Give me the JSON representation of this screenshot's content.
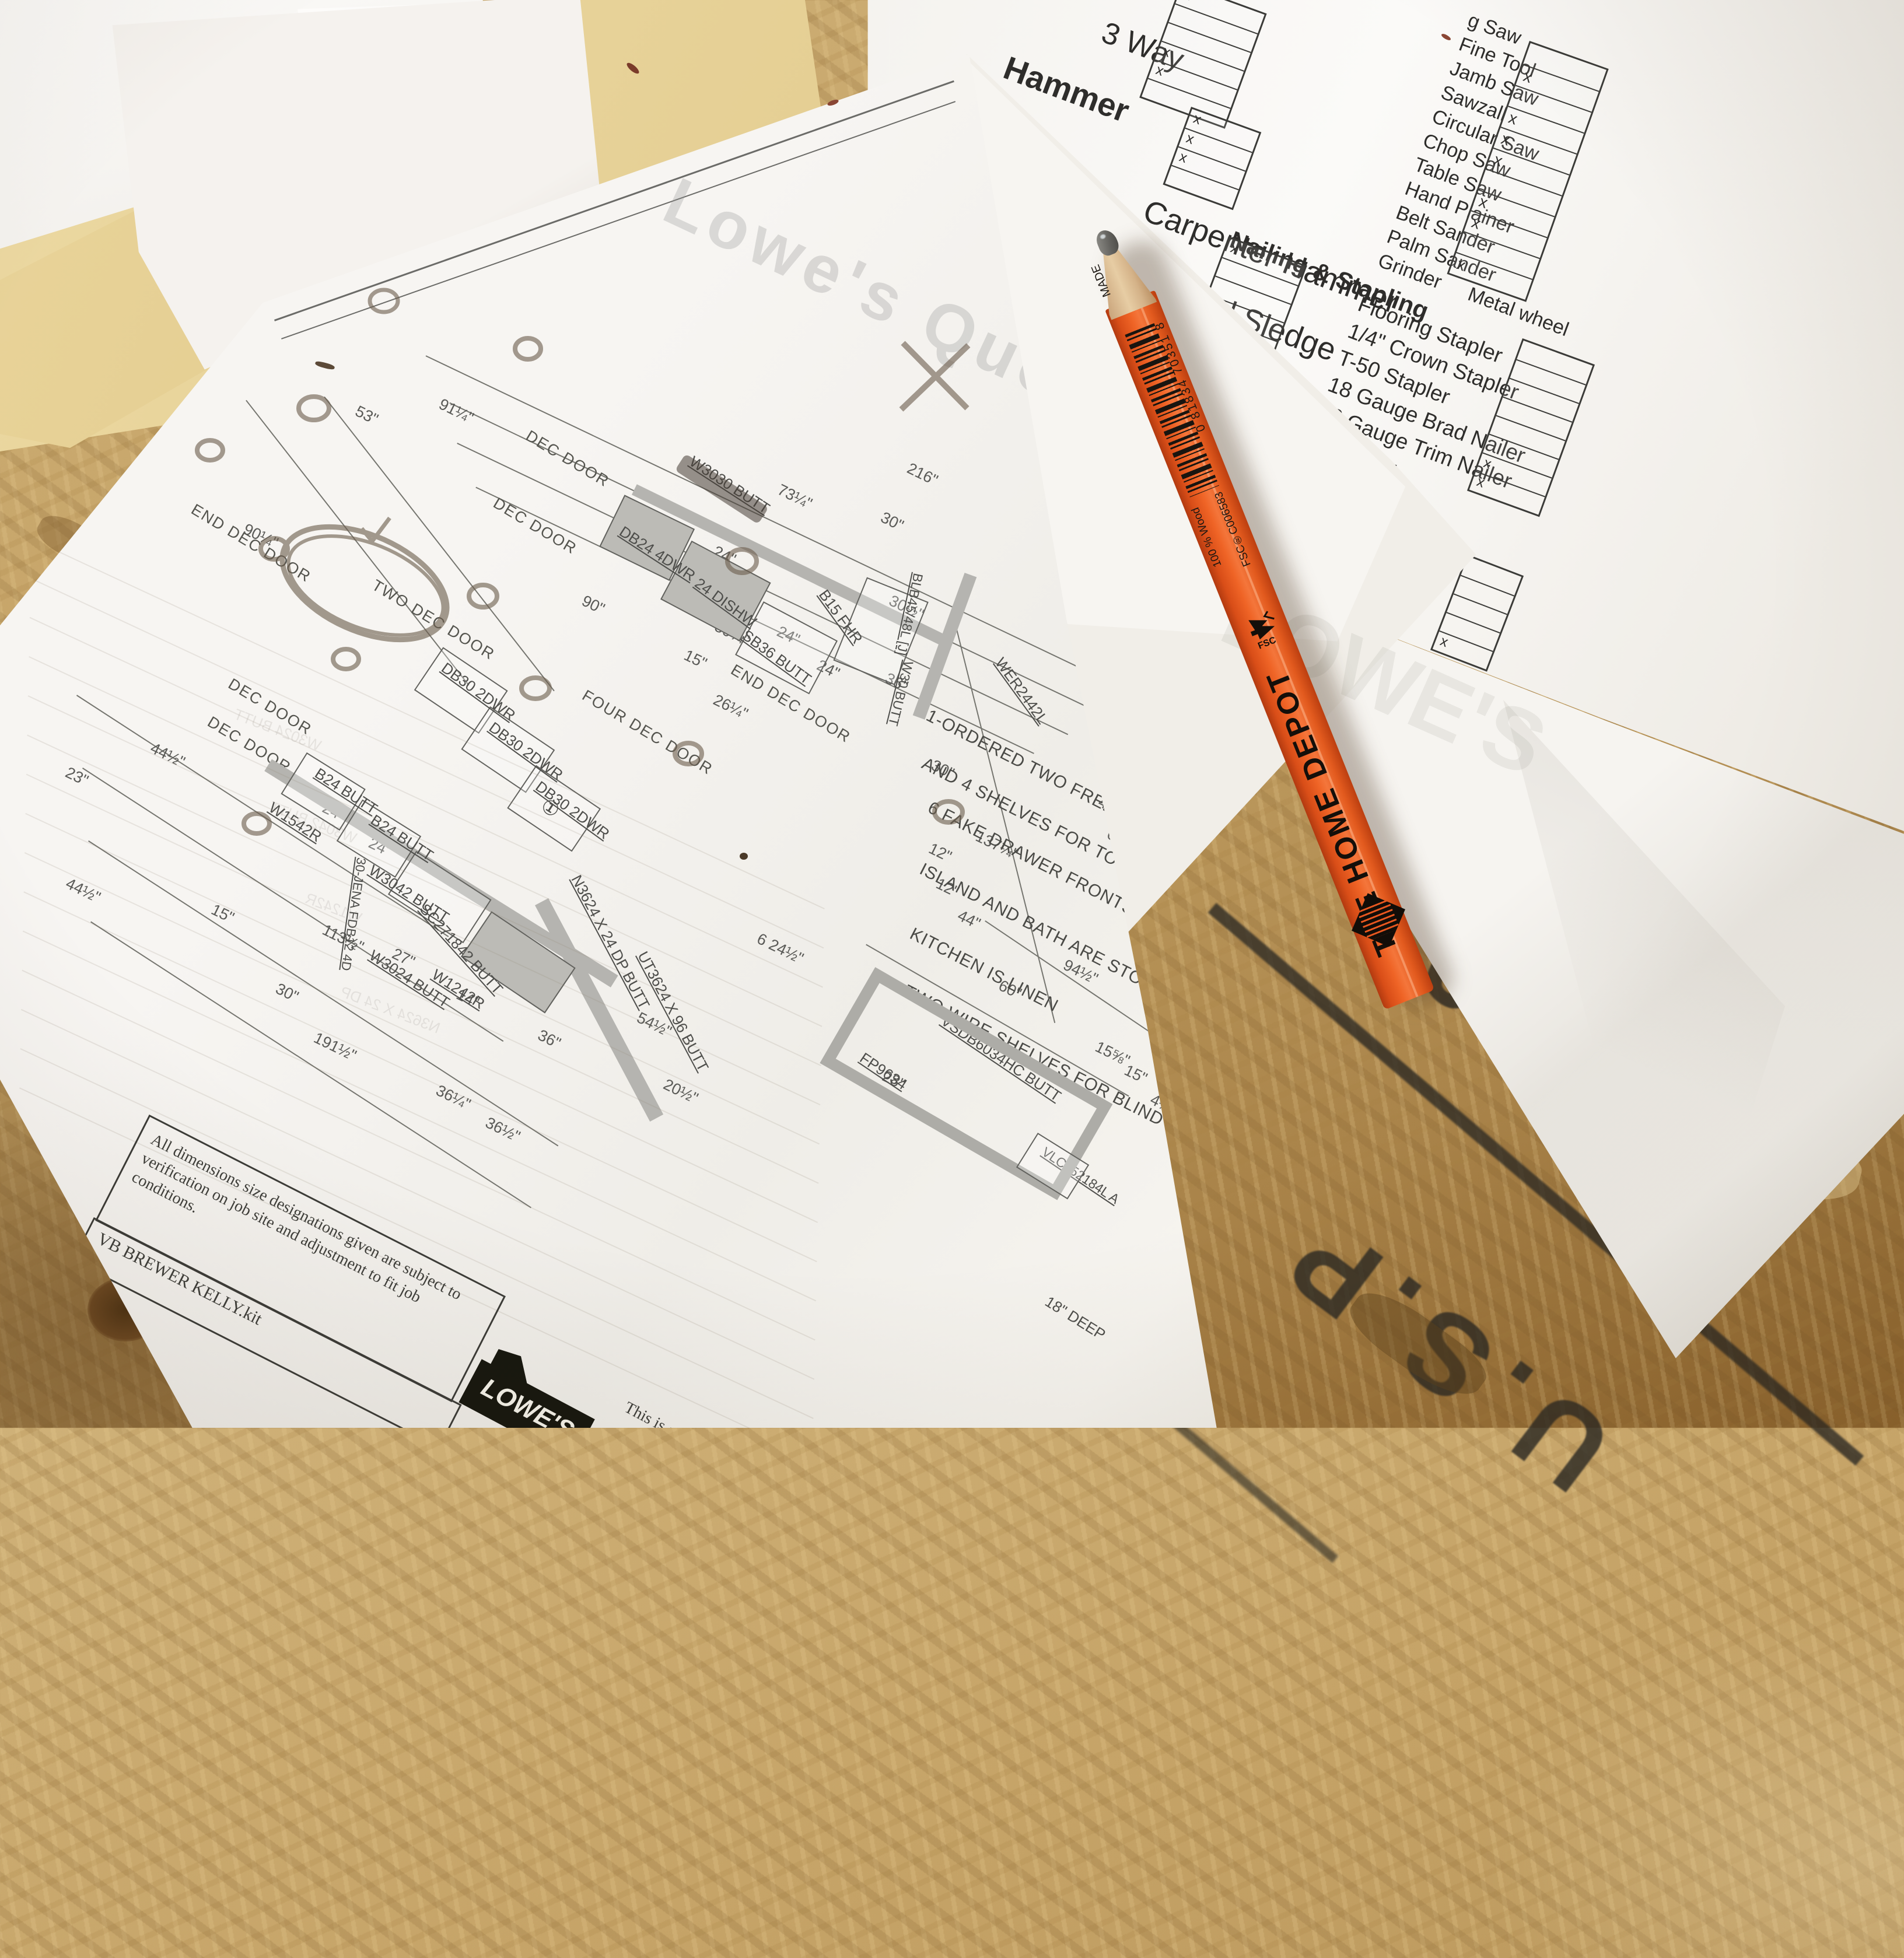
{
  "scene": "Photograph of kitchen cabinet blueprint, tool checklist and carpenter pencil on OSB board",
  "checklist": {
    "col1_sections": [
      {
        "title": "",
        "items": [
          "3 Way"
        ]
      },
      {
        "title": "Hammer",
        "items": [
          "Carpenter Hammer",
          "2 Pound Sledge",
          "Rubber Mallets"
        ]
      },
      {
        "title": "Measuring & Marking",
        "items": [
          "25'-30' Tape Measure",
          "100' Tape Measure"
        ]
      },
      {
        "title": "Nailing & Stapling",
        "items": [
          "Flooring Stapler",
          "1/4\" Crown Stapler",
          "T-50 Stapler",
          "18 Gauge Brad Nailer",
          "16 Gauge Trim Nailer",
          "Nailer"
        ]
      }
    ],
    "col2_items": [
      "g Saw",
      "Fine Tool",
      "Jamb Saw",
      "Sawzall",
      "Circular Saw",
      "Chop Saw",
      "Table Saw",
      "Hand Plainer",
      "Belt Sander",
      "Palm Sander",
      "Grinder  Metal wheel"
    ],
    "tables": [
      {
        "rows": [
          "x",
          "",
          "",
          "x",
          "x",
          ""
        ]
      },
      {
        "rows": [
          "x",
          "x",
          "x",
          ""
        ]
      },
      {
        "rows": [
          "",
          "x",
          "",
          "x",
          "x",
          "x",
          "",
          "x",
          "x",
          "",
          "x"
        ]
      },
      {
        "rows": [
          "x",
          "",
          "",
          "",
          ""
        ]
      },
      {
        "rows": [
          "",
          "",
          "",
          "",
          "",
          "",
          "x",
          "x"
        ]
      },
      {
        "rows": [
          "",
          "",
          "",
          "",
          "x"
        ]
      }
    ]
  },
  "blueprint": {
    "watermark": "Lowe's Quote",
    "door_labels": [
      "DEC DOOR",
      "DEC DOOR",
      "DEC DOOR",
      "DEC DOOR",
      "END DEC DOOR",
      "TWO DEC DOOR",
      "FOUR DEC DOOR",
      "END DEC DOOR"
    ],
    "cabinet_labels": [
      "W3030 BUTT",
      "DB24 4DWR",
      "24 DISHW",
      "SB36 BUTT",
      "B15 FHR",
      "WER2442L",
      "BLB45/48L [J]",
      "W30 BUTT",
      "DB30 2DWR",
      "DB30 2DWR",
      "DB30 2DWR",
      "B24 BUTT",
      "B24 BUTT",
      "W1542R",
      "W3042 BUTT",
      "SC271842 BUTT",
      "W3024 BUTT",
      "W1242R",
      "30-JENA FDB12 4D",
      "N3624 X 24 DP BUTT",
      "UT3624 X 96 BUTT",
      "VSDB6034HC BUTT",
      "VLC152184L A",
      "FP9634",
      "18\" DEEP",
      "①"
    ],
    "dims": [
      "53\"",
      "91¼\"",
      "90¼\"",
      "216\"",
      "73¼\"",
      "30\"",
      "24\"",
      "30½\"",
      "24\"",
      "36\"",
      "59¼\"",
      "15\"",
      "26¼\"",
      "24\"",
      "48\"",
      "63\"",
      "90\"",
      "23\"",
      "44½\"",
      "44½\"",
      "24\"",
      "24\"",
      "15\"",
      "113½\"",
      "30\"",
      "27\"",
      "14\"",
      "36\"",
      "36\"",
      "54½\"",
      "36½\"",
      "191½\"",
      "12\"",
      "44\"",
      "12\"",
      "137¼\"",
      "30\"",
      "20½\"",
      "28\"",
      "6 24½\"",
      "60\"",
      "94½\"",
      "15⅝\"",
      "15\"",
      "4½\"",
      "36¼\""
    ],
    "notes": [
      "1-ORDERED TWO FREE AND TWO MORE ADD PANTRY ROLL OUTS",
      "AND 4 SHELVES FOR TOP",
      "6 FAKE DRAWER FRONTS FOR ISLAND",
      "ISLAND AND BATH ARE STONE COLOR",
      "KITCHEN IS LINEN",
      "TWO WIRE SHELVES FOR BLIND BASE"
    ],
    "disclaimer": "All dimensions  size designations given are subject to verification on job site and adjustment to fit job conditions.",
    "project": "VB BREWER KELLY.kit",
    "logo_text": "LOWE'S",
    "copyright_lines": [
      "This is an original design and mus",
      "released or copied unless appli",
      "been paid or job order place"
    ]
  },
  "pencil": {
    "brand": "THE HOME DEPOT",
    "made": "MADE",
    "barcode_digits": "0 81834 70351 8",
    "fsc_label": "FSC",
    "wood_label": "100 % Wood",
    "fsc_code": "FSC®C006583",
    "body_color": "#e8571f"
  },
  "stamp": {
    "line1": "11501",
    "line2": "U.S.P",
    "ink_color": "#2c2923"
  }
}
